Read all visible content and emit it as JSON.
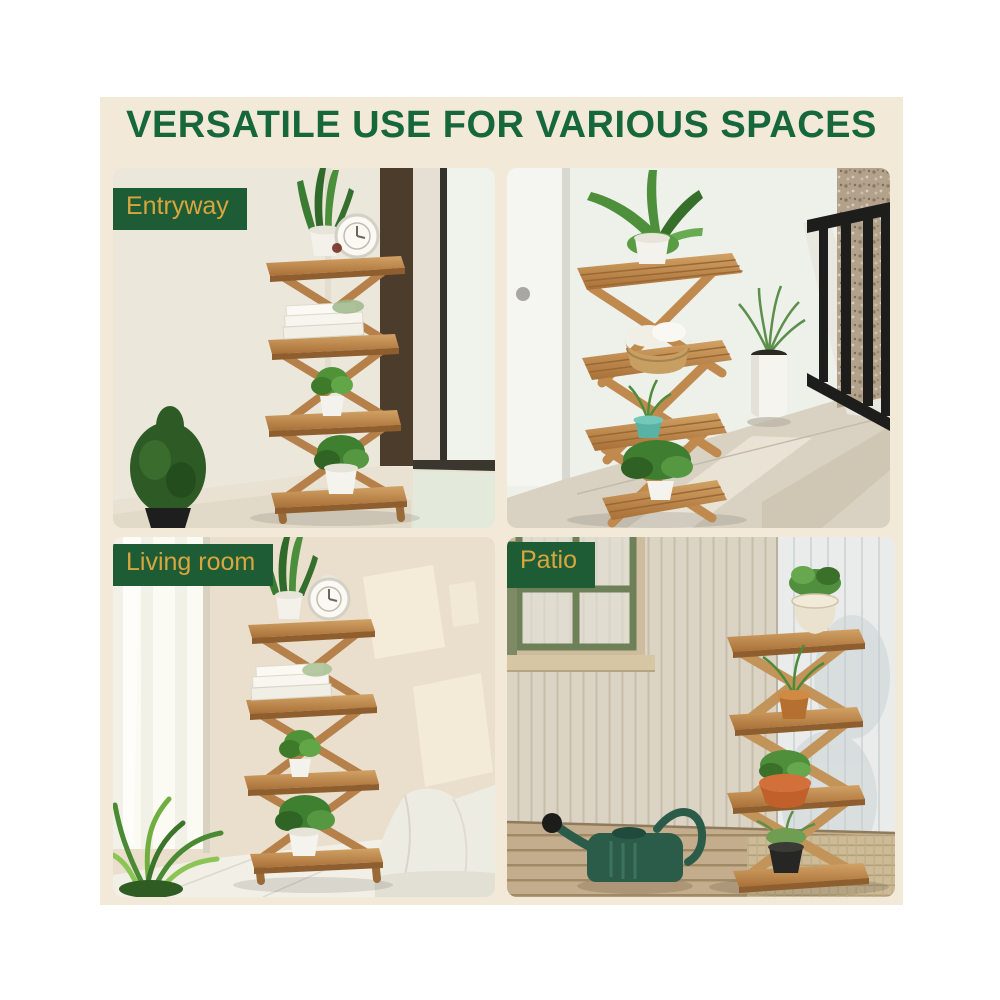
{
  "title": {
    "text": "VERSATILE USE FOR VARIOUS SPACES"
  },
  "panels": {
    "entryway": {
      "label": "Entryway"
    },
    "living_room": {
      "label": "Living room"
    },
    "patio": {
      "label": "Patio"
    }
  },
  "colors": {
    "page_background": "#ffffff",
    "poster_background": "#f3e9d8",
    "title_green": "#17673d",
    "badge_green": "#1e5c36",
    "badge_gold": "#d9a63e",
    "wood": "#c08a50",
    "watering_can_green": "#2b5c4a",
    "teal_pot": "#58b3a5"
  }
}
